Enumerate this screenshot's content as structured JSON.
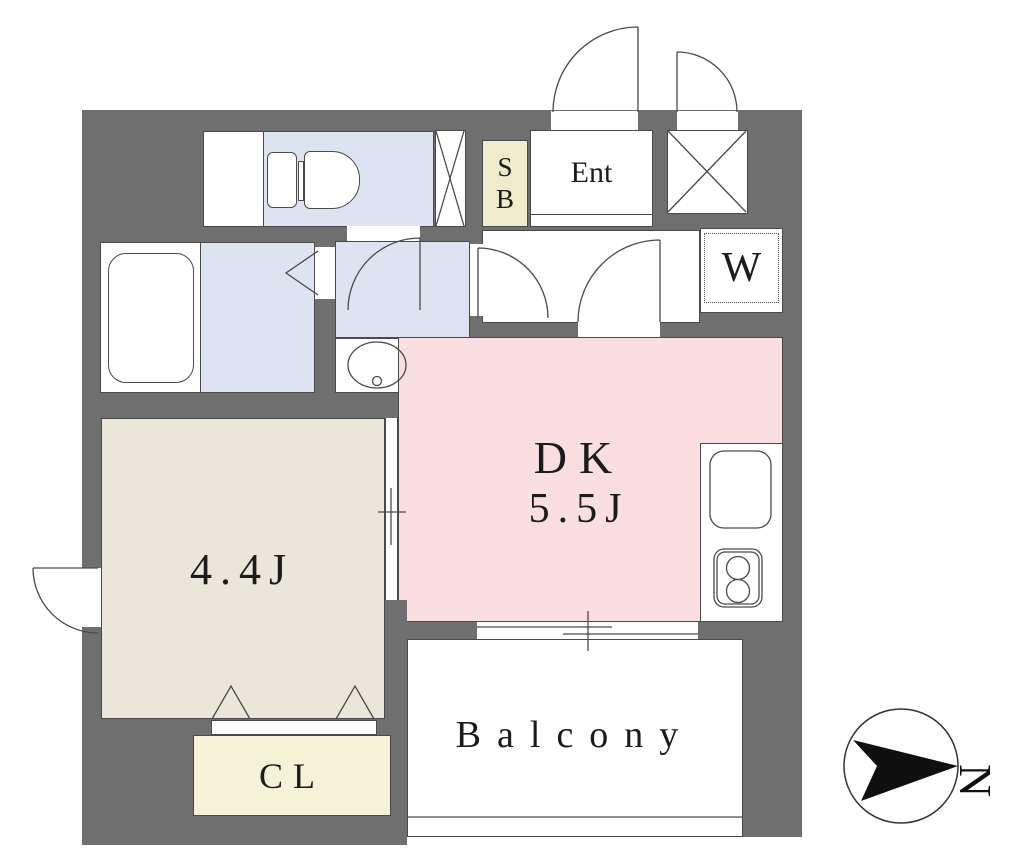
{
  "labels": {
    "shoe_box_line1": "S",
    "shoe_box_line2": "B",
    "entrance": "Ent",
    "washer": "W",
    "dk_name": "DK",
    "dk_size": "5.5J",
    "room_size": "4.4J",
    "closet": "CL",
    "balcony": "Balcony",
    "compass_north": "N"
  },
  "colors": {
    "wall": "#6f6f6f",
    "wet": "#dde3f1",
    "dkc": "#fbdee2",
    "roomc": "#eae6d9",
    "clc": "#f5f3d7",
    "sbc": "#efeccd",
    "line": "#4a4a4a"
  },
  "icons": {
    "pipe_space": "x-cross",
    "compass": "north-arrow"
  }
}
